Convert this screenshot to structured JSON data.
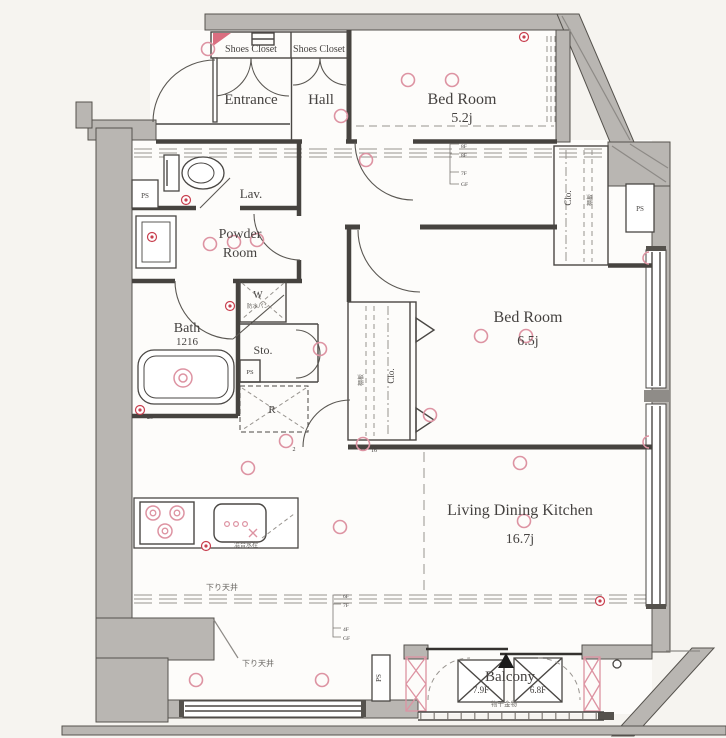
{
  "title": "Apartment floor plan",
  "colors": {
    "pink": "#dd93a2",
    "red": "#c8404f",
    "wall": "#b9b6b2",
    "line": "#46433f"
  },
  "rooms": {
    "entrance": "Entrance",
    "hall": "Hall",
    "shoes_closet_1": "Shoes Closet",
    "shoes_closet_2": "Shoes Closet",
    "bedroom1": {
      "name": "Bed Room",
      "size": "5.2j"
    },
    "bedroom2": {
      "name": "Bed Room",
      "size": "6.5j"
    },
    "ldk": {
      "name": "Living Dining Kitchen",
      "size": "16.7j"
    },
    "lavatory": "Lav.",
    "powder_room": {
      "line1": "Powder",
      "line2": "Room"
    },
    "bath": {
      "name": "Bath",
      "size": "1216"
    },
    "storage": "Sto.",
    "balcony": "Balcony"
  },
  "labels": {
    "washer": "W",
    "washer_sub": "防水パン",
    "fridge": "R",
    "closet_tr": "Clo.",
    "closet_br2": "Clo.",
    "shelf_tr": "棚板",
    "shelf_br2": "棚板",
    "ps1": "PS",
    "ps2": "PS",
    "ps3": "PS",
    "ps4": "PS",
    "lowered_ceiling_1": "下り天井",
    "lowered_ceiling_2": "下り天井",
    "laundry_hw": "物干金物",
    "kitchen_sub": "混合水栓",
    "ac1": "7.9F",
    "ac2": "6.8F",
    "floor_refs1": [
      "8F",
      "8F",
      "7F",
      "GF"
    ],
    "floor_refs2": [
      "6F",
      "7F",
      "4F",
      "GF"
    ]
  },
  "symbols": [
    {
      "t": "light",
      "x": 208,
      "y": 49
    },
    {
      "t": "light",
      "x": 341,
      "y": 116
    },
    {
      "t": "light",
      "x": 408,
      "y": 80
    },
    {
      "t": "light",
      "x": 452,
      "y": 80
    },
    {
      "t": "light",
      "x": 366,
      "y": 160
    },
    {
      "t": "light",
      "x": 210,
      "y": 244
    },
    {
      "t": "light",
      "x": 234,
      "y": 242
    },
    {
      "t": "light",
      "x": 257,
      "y": 240
    },
    {
      "t": "light",
      "x": 320,
      "y": 349
    },
    {
      "t": "light",
      "x": 481,
      "y": 336
    },
    {
      "t": "light",
      "x": 526,
      "y": 336
    },
    {
      "t": "light",
      "x": 286,
      "y": 441
    },
    {
      "t": "light",
      "x": 363,
      "y": 444
    },
    {
      "t": "light",
      "x": 520,
      "y": 463
    },
    {
      "t": "light",
      "x": 524,
      "y": 521
    },
    {
      "t": "light",
      "x": 340,
      "y": 527
    },
    {
      "t": "light",
      "x": 248,
      "y": 468
    },
    {
      "t": "light",
      "x": 196,
      "y": 680
    },
    {
      "t": "light",
      "x": 322,
      "y": 680
    },
    {
      "t": "light",
      "x": 430,
      "y": 415
    },
    {
      "t": "target",
      "x": 183,
      "y": 378
    },
    {
      "t": "burner",
      "x": 153,
      "y": 513
    },
    {
      "t": "burner",
      "x": 177,
      "y": 513
    },
    {
      "t": "burner",
      "x": 165,
      "y": 531
    },
    {
      "t": "dot",
      "x": 227,
      "y": 524
    },
    {
      "t": "dot",
      "x": 236,
      "y": 524
    },
    {
      "t": "dot",
      "x": 245,
      "y": 524
    },
    {
      "t": "cross",
      "x": 253,
      "y": 533
    },
    {
      "t": "outlet",
      "x": 186,
      "y": 200
    },
    {
      "t": "outlet",
      "x": 524,
      "y": 37
    },
    {
      "t": "outlet",
      "x": 152,
      "y": 237
    },
    {
      "t": "outlet",
      "x": 140,
      "y": 410
    },
    {
      "t": "outlet",
      "x": 230,
      "y": 306
    },
    {
      "t": "outlet",
      "x": 206,
      "y": 546
    },
    {
      "t": "outlet",
      "x": 600,
      "y": 601
    },
    {
      "t": "semi",
      "x": 649,
      "y": 258
    },
    {
      "t": "semi",
      "x": 649,
      "y": 442
    },
    {
      "t": "num",
      "x": 350,
      "y": 110,
      "v": "2"
    },
    {
      "t": "num",
      "x": 294,
      "y": 451,
      "v": "2"
    },
    {
      "t": "num",
      "x": 150,
      "y": 419,
      "v": "20"
    },
    {
      "t": "num",
      "x": 374,
      "y": 452,
      "v": "16"
    }
  ]
}
